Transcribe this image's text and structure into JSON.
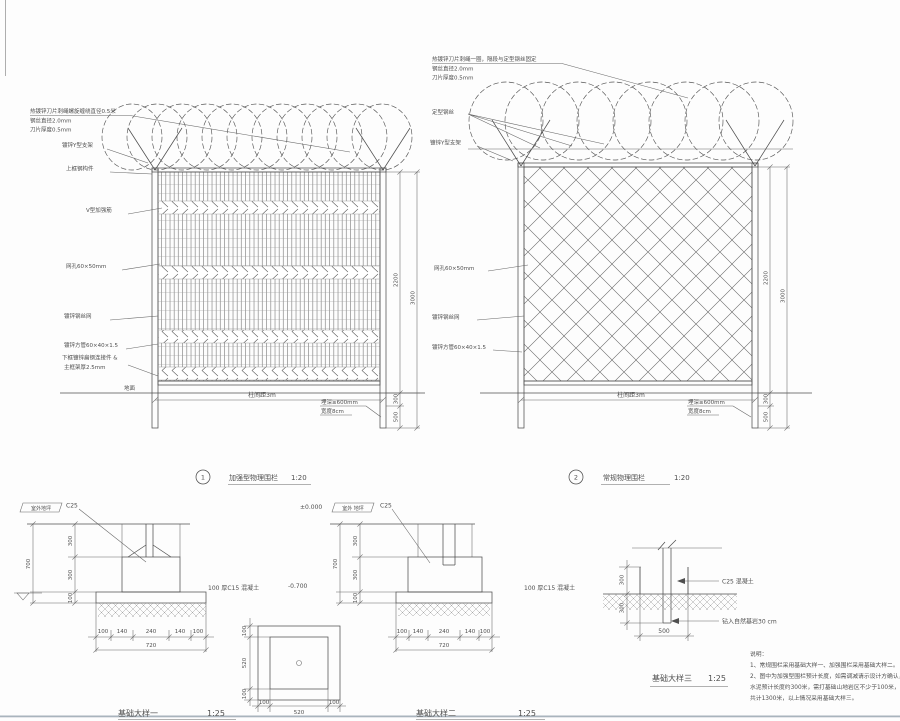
{
  "palette": {
    "line": "#4f4f4f",
    "background": "#fdfdfd",
    "window_edge": "#a9b4bd"
  },
  "fence1": {
    "spec1": "热镀锌刀片刺绳螺旋缠绕直径0.5米",
    "spec2": "钢丝直径2.0mm",
    "spec3": "刀片厚度0.5mm",
    "bracket": "镀锌Y型支架",
    "top_rail": "上框钢构件",
    "v_rib": "V型加强筋",
    "mesh_size": "网孔60×50mm",
    "mesh": "镀锌钢丝网",
    "tube": "镀锌方管60×40×1.5",
    "bottom_conn": "下框镀锌扁钢连接件 &",
    "frame_thick": "主框架厚2.5mm",
    "ground": "地面",
    "span": "柱间距3m",
    "embed_depth": "埋深≥600mm",
    "embed_width": "宽度8cm",
    "dim_mesh": "2200",
    "dim_total": "3000",
    "dim_b1": "300",
    "dim_b2": "500",
    "num": "1",
    "title": "加强型物理围栏",
    "scale": "1:20"
  },
  "fence2": {
    "spec1": "热镀锌刀片刺绳一圈，隔段与定型钢丝固定",
    "spec2": "钢丝直径2.0mm",
    "spec3": "刀片厚度0.5mm",
    "wire": "定型钢丝",
    "bracket": "镀锌Y型支架",
    "mesh_size": "网孔60×50mm",
    "mesh": "镀锌钢丝网",
    "tube": "镀锌方管60×40×1.5",
    "span": "柱间距3m",
    "embed_depth": "埋深≥600mm",
    "embed_width": "宽度8cm",
    "dim_mesh": "2200",
    "dim_total": "3000",
    "dim_b1": "300",
    "dim_b2": "500",
    "num": "2",
    "title": "常规物理围栏",
    "scale": "1:20"
  },
  "foundA": {
    "level_label": "室外地坪",
    "c25": "C25",
    "slab_note": "100 厚C15 混凝土",
    "level": "-0.700",
    "d300a": "300",
    "d300b": "300",
    "d100": "100",
    "d700": "700",
    "b100a": "100",
    "b140a": "140",
    "b240": "240",
    "b140b": "140",
    "b100b": "100",
    "b720": "720",
    "title": "基础大样一",
    "scale": "1:25"
  },
  "foundB": {
    "level_value": "±0.000",
    "level_label": "室外 地坪",
    "c25": "C25",
    "slab_note": "100 厚C15 混凝土",
    "d300a": "300",
    "d300b": "300",
    "d100": "100",
    "d700": "700",
    "b100a": "100",
    "b140a": "140",
    "b240": "240",
    "b140b": "140",
    "b100b": "100",
    "b720": "720",
    "title": "基础大样二",
    "scale": "1:25"
  },
  "plan": {
    "l100a": "100",
    "l520": "520",
    "l100b": "100",
    "b100a": "100",
    "b520": "520",
    "b100b": "100"
  },
  "foundC": {
    "c25": "C25 混凝土",
    "rock": "钻入自然基岩30 cm",
    "d300a": "300",
    "d300b": "300",
    "d500": "500",
    "title": "基础大样三",
    "scale": "1:25"
  },
  "notes": {
    "t": "说明：",
    "l1": "1、常规围栏采用基础大样一、加强围栏采用基础大样二。",
    "l2": "2、图中为加强型围栏预计长度，如需调减请示设计方确认，",
    "l3": "水泥预计长度约300米，需打基础山地岩区不少于100米，",
    "l4": "共计1300米，以上情况采用基础大样三。"
  }
}
